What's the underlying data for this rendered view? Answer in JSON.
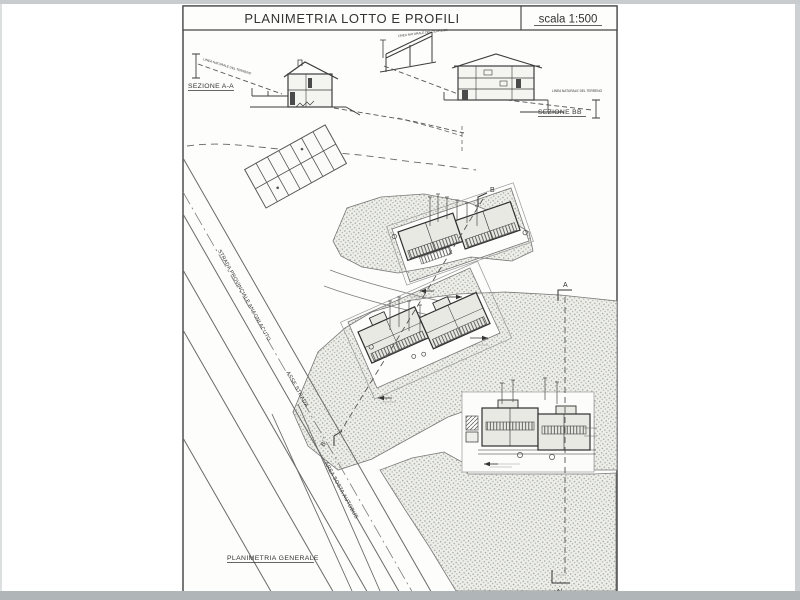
{
  "title_block": {
    "title": "PLANIMETRIA LOTTO E PROFILI",
    "scale": "scala 1:500"
  },
  "sections": {
    "aa": {
      "label": "SEZIONE A-A"
    },
    "bb": {
      "label": "SEZIONE BB"
    },
    "terrain_note": "LINEA NATURALE DEL TERRENO"
  },
  "plan": {
    "caption": "PLANIMETRIA GENERALE",
    "labels": {
      "road": "STRADA PROVINCIALE ANAGNI ACUTO",
      "axis": "ASSE STRADA",
      "bus": "AREA SOSTA AUTOBUS"
    },
    "markers": {
      "b_top": "B",
      "b_bottom": "B'",
      "a_top": "A",
      "a_bottom": "A'"
    }
  },
  "colors": {
    "ink": "#3a3a3a",
    "light_ink": "#6f6f6f",
    "stipple": "#9aa095",
    "paper": "#fdfdfb",
    "building_fill": "#e9e9e4"
  }
}
